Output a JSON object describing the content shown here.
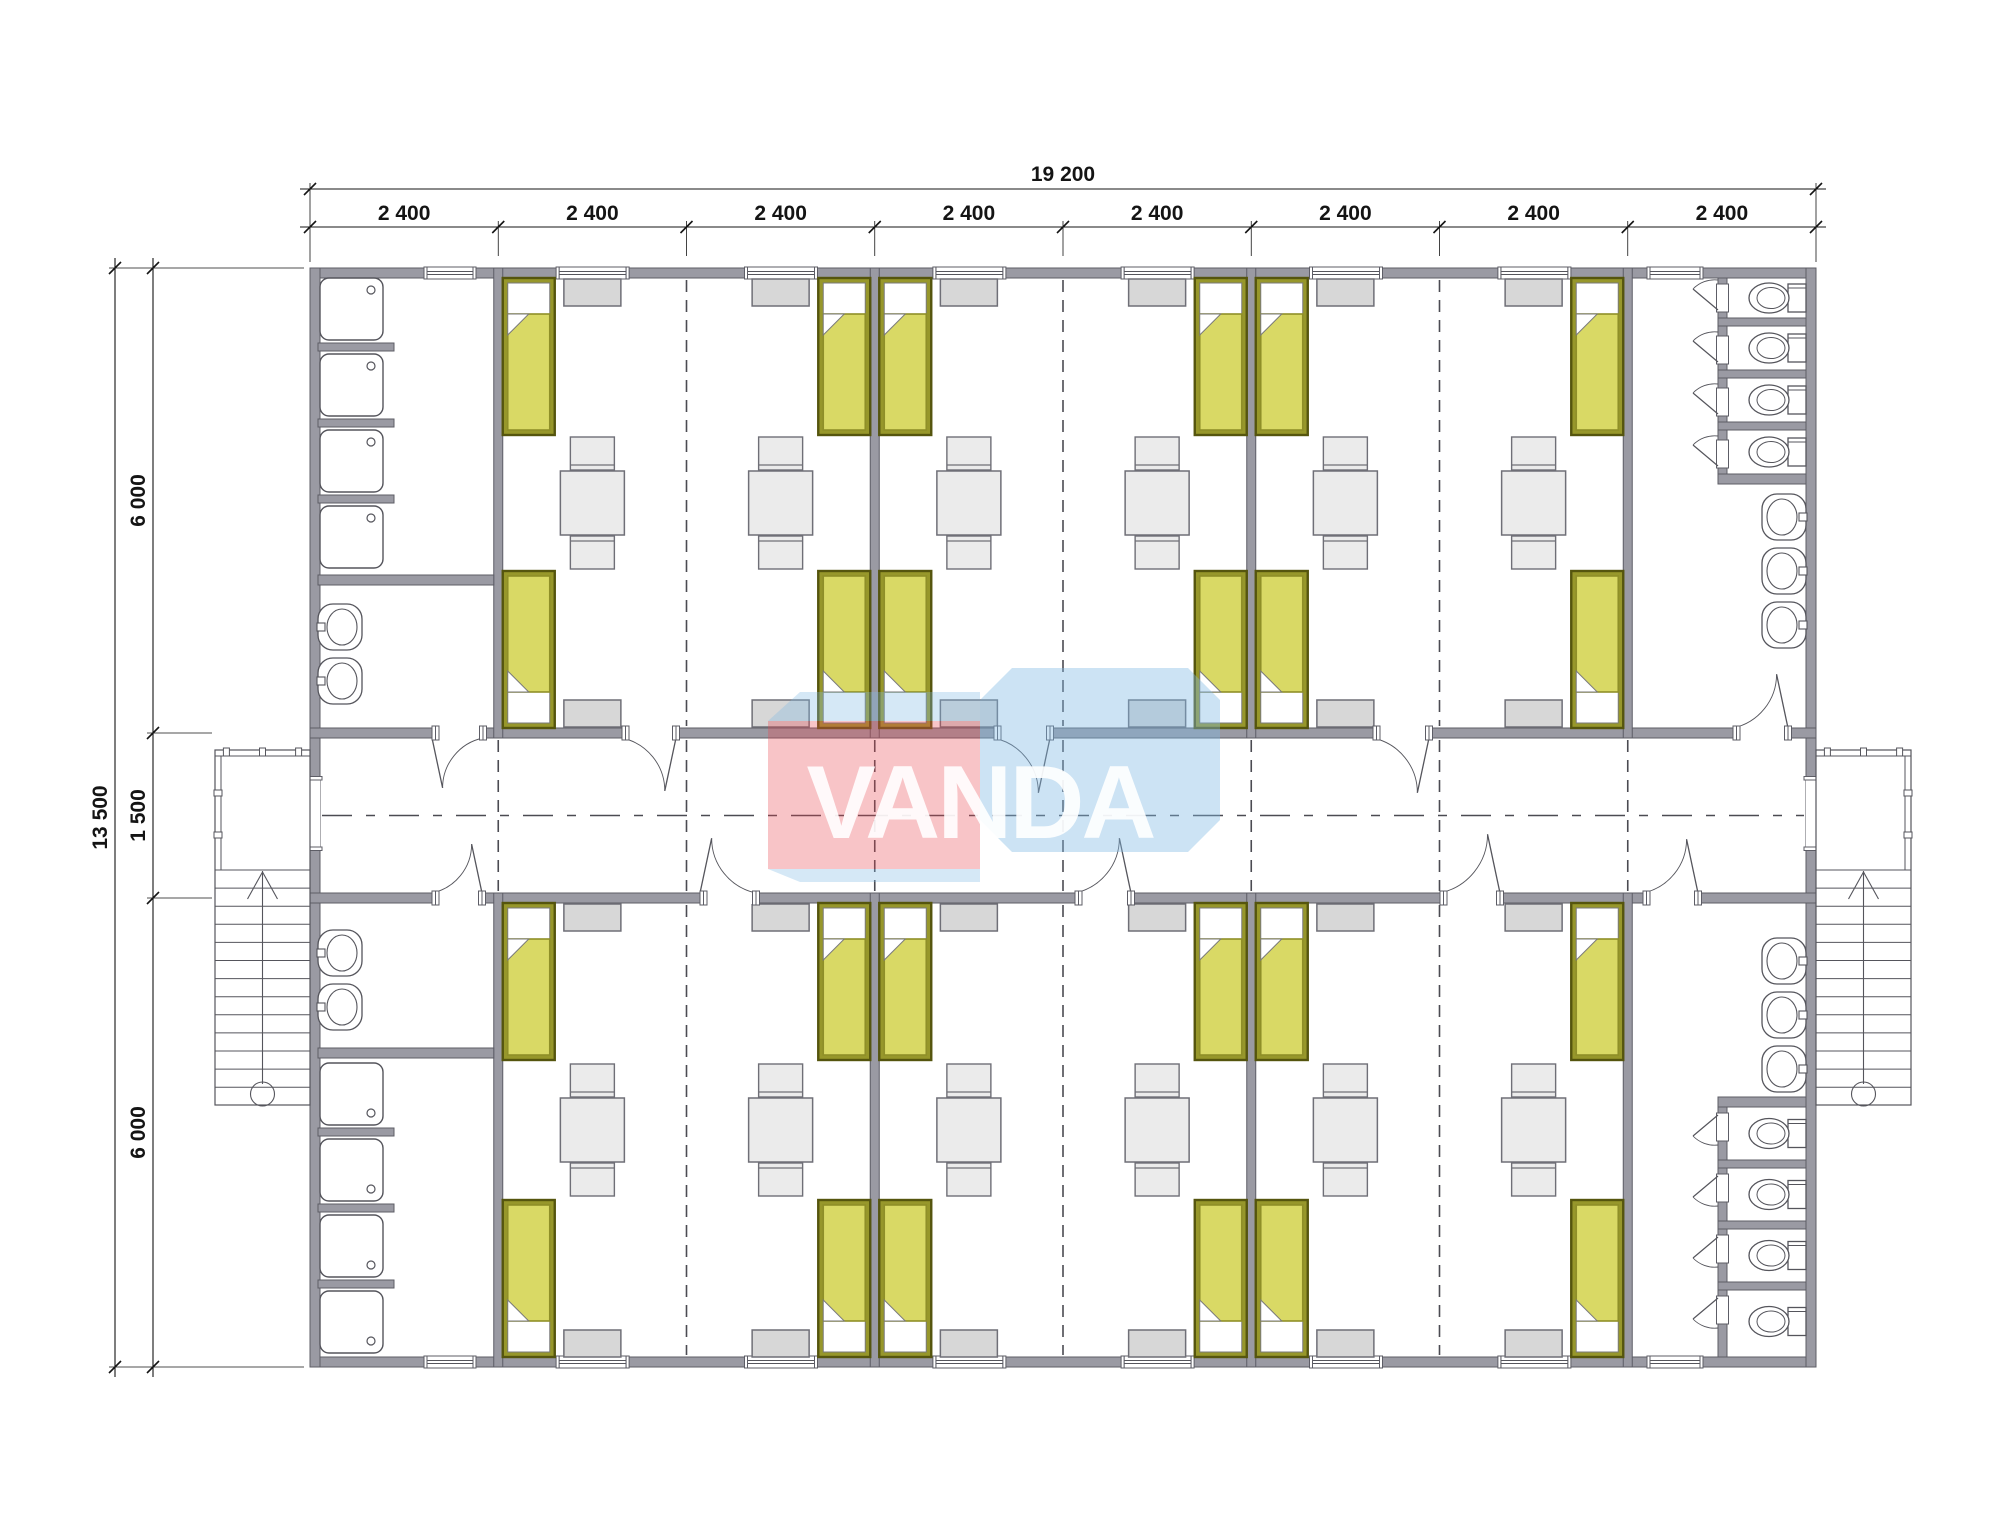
{
  "drawing": {
    "kind": "floor-plan",
    "watermark": {
      "text": "VANDA",
      "front_color": "rgba(232,70,82,0.32)",
      "box_color": "rgba(128,184,228,0.40)",
      "band_color": "rgba(128,184,228,0.33)",
      "letter_color": "rgba(255,255,255,0.90)"
    },
    "dimensions": {
      "top": {
        "total": "19 200",
        "segments": [
          "2 400",
          "2 400",
          "2 400",
          "2 400",
          "2 400",
          "2 400",
          "2 400",
          "2 400"
        ]
      },
      "left": {
        "total": "13 500",
        "segments": [
          "6 000",
          "1 500",
          "6 000"
        ]
      }
    },
    "plan": {
      "modules": 8,
      "module_width_mm": 2400,
      "building_width_mm": 19200,
      "wing_depth_mm": 6000,
      "corridor_width_mm": 1500,
      "building_depth_mm": 13500,
      "bedrooms": {
        "count": 6,
        "beds_per_room": 4,
        "tables_per_room": 2,
        "chairs_per_table": 2,
        "lockers_per_room": 4,
        "windows_per_room": 4
      },
      "shower_rooms": {
        "count": 2,
        "showers_each": 4,
        "sinks_each": 2
      },
      "toilet_rooms": {
        "count": 2,
        "toilets_each": 4,
        "sinks_each": 3
      },
      "stairs": {
        "count": 2
      },
      "porches": {
        "count": 2
      }
    },
    "colors": {
      "paper": "#ffffff",
      "wall_fill": "#9a9aa3",
      "wall_stroke": "#5d5d66",
      "line": "#55555c",
      "dash": "#4b4b52",
      "dim": "#141414",
      "bed_frame": "#97972b",
      "bed_frame_stroke": "#55550e",
      "blanket": "#d9d965",
      "blanket_stroke": "#8f8f28",
      "pillow": "#ffffff",
      "furniture": "#ebebeb",
      "locker": "#d7d7d7",
      "furniture_stroke": "#6f6f77"
    }
  }
}
